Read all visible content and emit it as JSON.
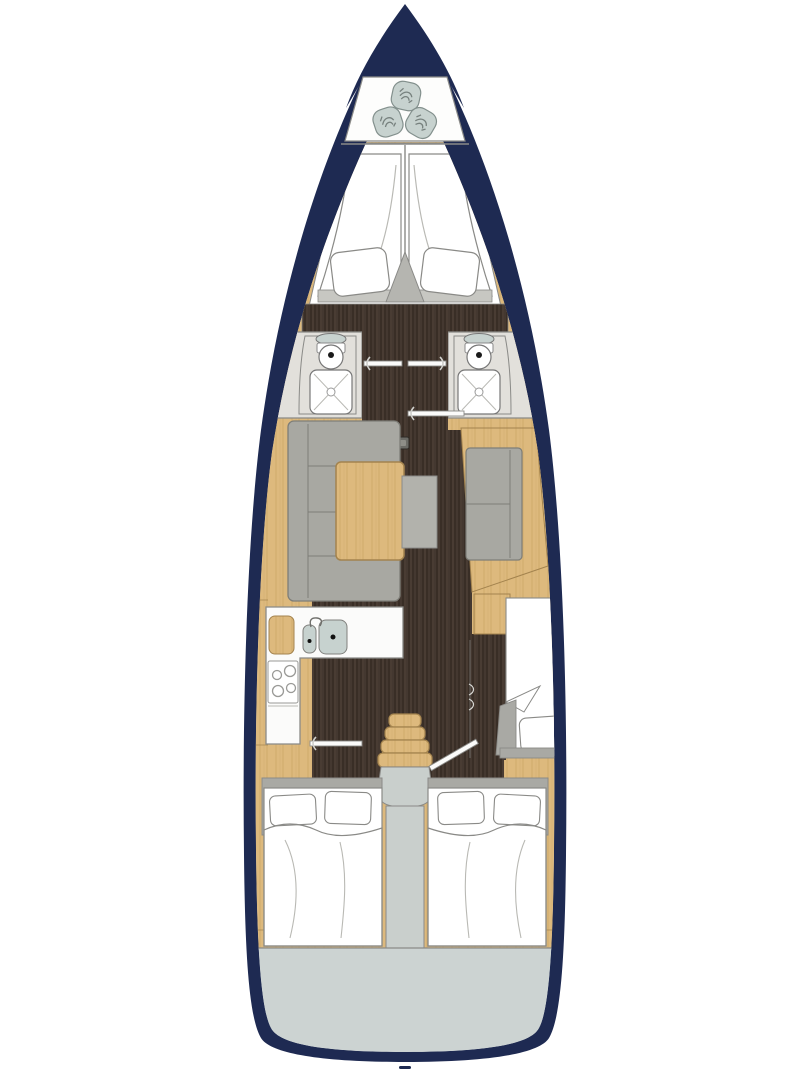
{
  "colors": {
    "page_bg": "#ffffff",
    "hull_navy": "#1e2a52",
    "wood_tan": "#ddb97d",
    "wood_tan_grain": "#c8a160",
    "wood_edge": "#a3834e",
    "wood_dark": "#443830",
    "wood_dark_grain": "#2d241d",
    "wood_dark_hi": "#5c4c3e",
    "upholstery_gray": "#a8a8a2",
    "upholstery_edge": "#7e7e78",
    "wall_gray": "#e2e0db",
    "fixture_white": "#fbfbfa",
    "basin_gray": "#c7d2cf",
    "outline_gray": "#8a8a87",
    "line_soft": "#b9b9b4",
    "soft_gray": "#c7c7c2",
    "transom_gray": "#ccd3d2",
    "landing_gray": "#c9cfcc",
    "hatch_dark": "#6b6b66"
  },
  "areas": [
    "anchor-locker",
    "owner-cabin-v-berths",
    "head-port",
    "head-starboard",
    "saloon",
    "galley",
    "companionway-stairs",
    "mid-cabin-starboard",
    "aft-cabin-port",
    "aft-cabin-starboard",
    "transom"
  ],
  "icons": [
    "rope-coil-icon",
    "sink-icon",
    "faucet-icon",
    "toilet-icon",
    "shower-tray-icon",
    "stove-burners-icon",
    "door-icon",
    "floor-hatch-icon",
    "wardrobe-handle-icon",
    "keel-mark-icon"
  ]
}
